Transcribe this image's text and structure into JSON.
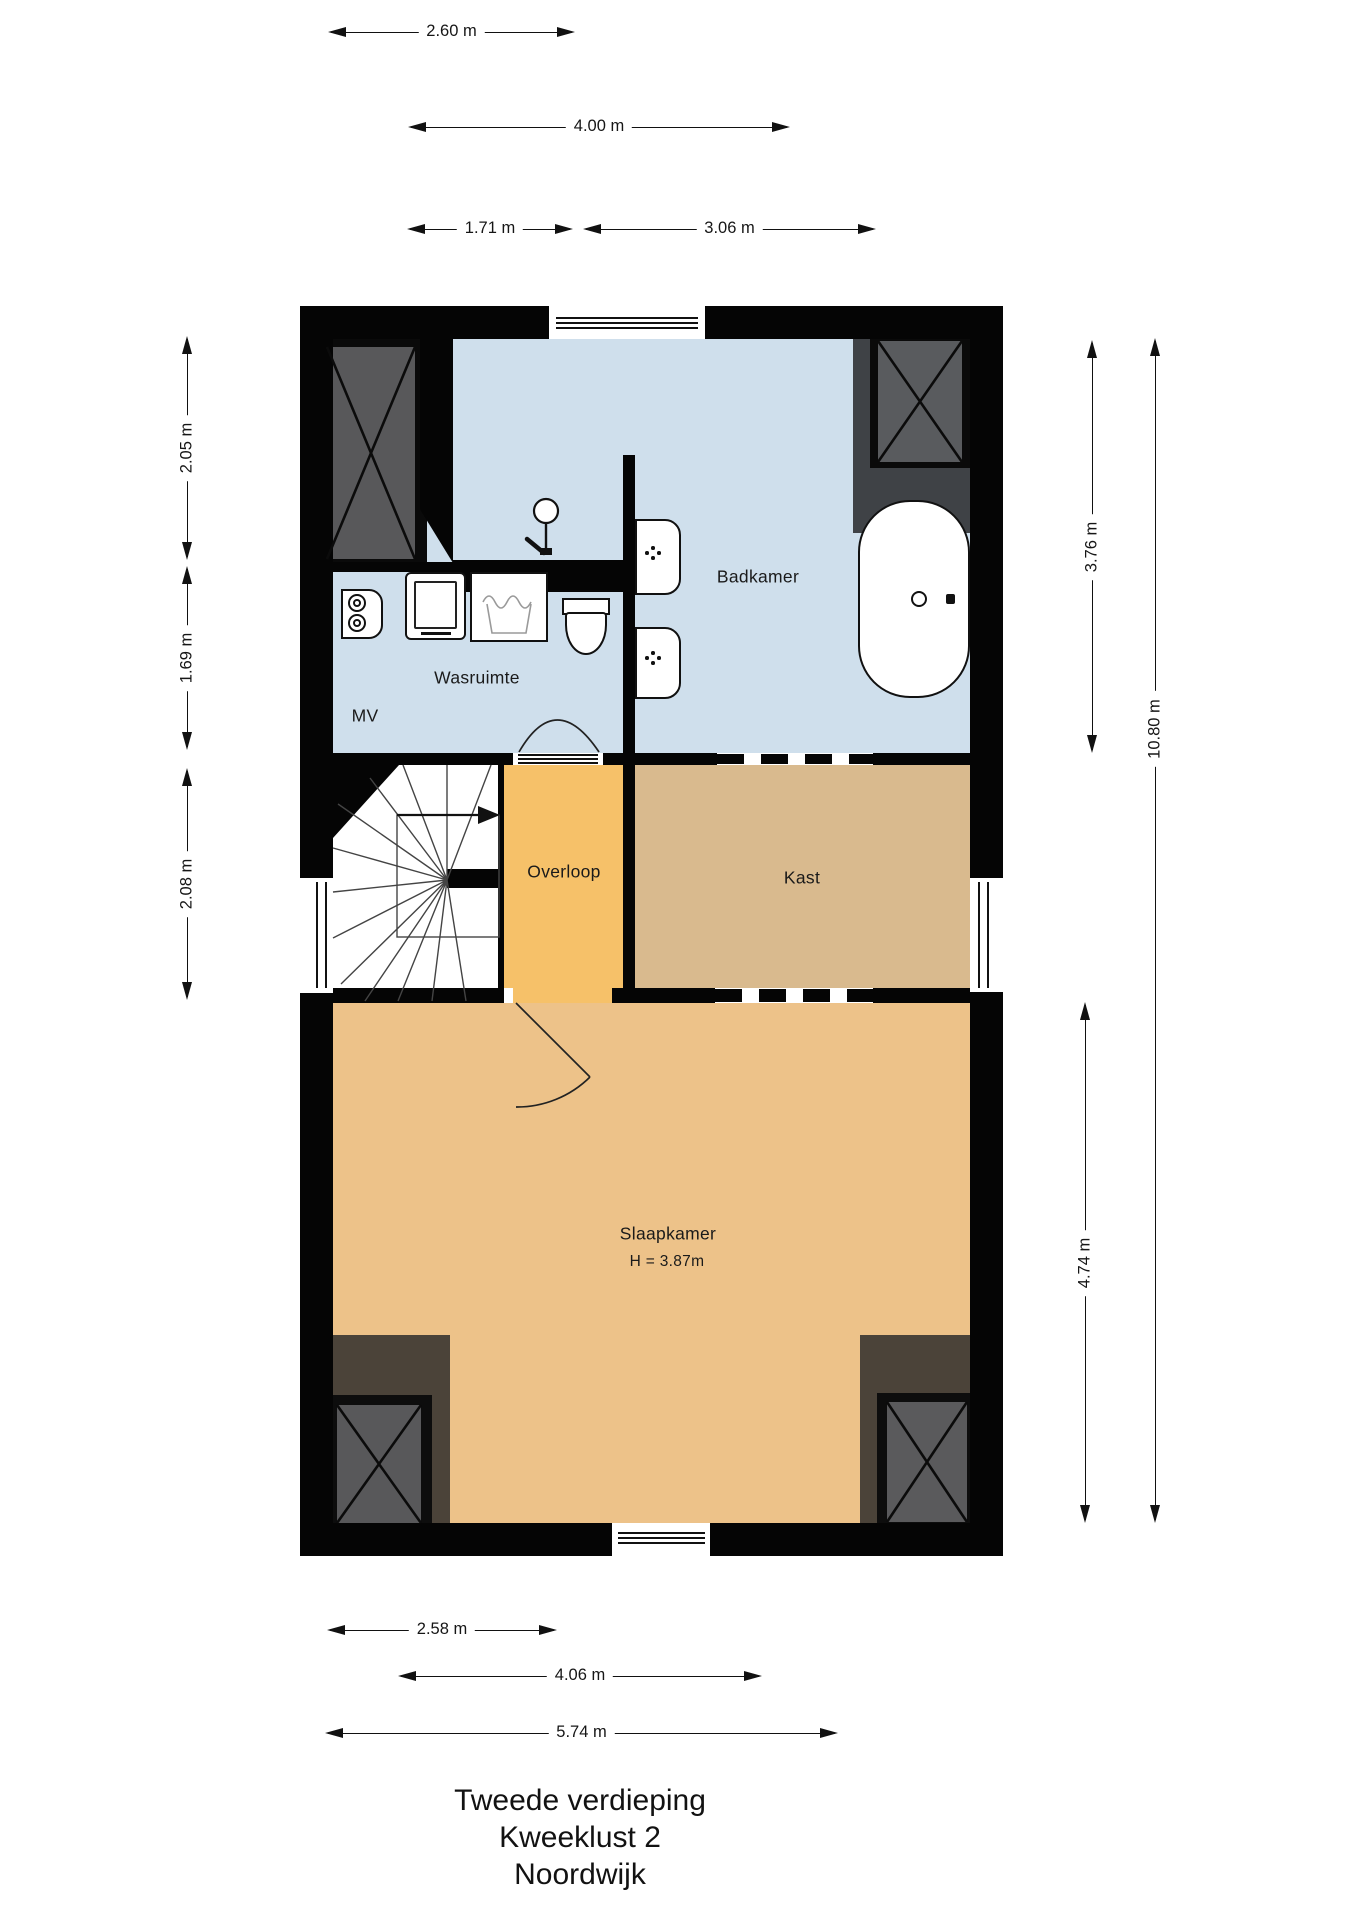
{
  "floorplan": {
    "title_lines": [
      "Tweede verdieping",
      "Kweeklust 2",
      "Noordwijk"
    ],
    "rooms": {
      "badkamer": "Badkamer",
      "wasruimte": "Wasruimte",
      "mv": "MV",
      "overloop": "Overloop",
      "kast": "Kast",
      "slaapkamer": "Slaapkamer",
      "slaapkamer_height": "H = 3.87m"
    },
    "dimensions": {
      "top": [
        "2.60 m",
        "4.00 m",
        "1.71 m",
        "3.06 m"
      ],
      "bottom": [
        "2.58 m",
        "4.06 m",
        "5.74 m"
      ],
      "left": [
        "2.05 m",
        "1.69 m",
        "2.08 m"
      ],
      "right": [
        "3.76 m",
        "10.80 m",
        "4.74 m"
      ]
    },
    "fixtures": [
      "bathtub",
      "toilet",
      "sink",
      "shower",
      "washing-machine",
      "boiler",
      "laundry-sink",
      "stairs",
      "storage-closet-x"
    ],
    "colors": {
      "bathroom_floor": "#CFDFEC",
      "landing_floor": "#F6C169",
      "closet_floor": "#D9BA8E",
      "bedroom_floor": "#EDC289",
      "wall": "#050505"
    }
  }
}
